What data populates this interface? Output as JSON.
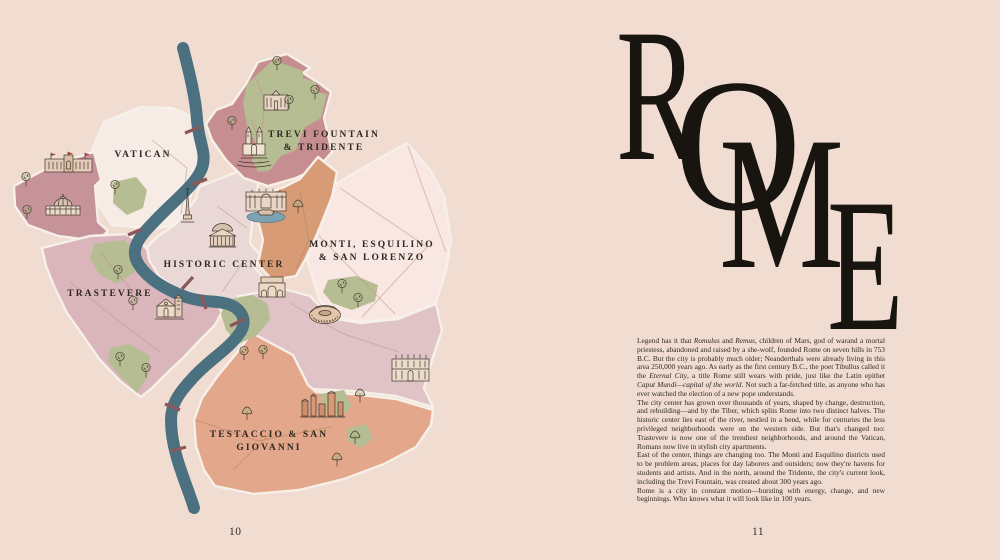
{
  "book": {
    "left_page": {
      "page_number": "10",
      "map_labels": {
        "vatican": "VATICAN",
        "trevi_line1": "TREVI FOUNTAIN",
        "trevi_line2": "& TRIDENTE",
        "historic": "HISTORIC CENTER",
        "monti_line1": "MONTI, ESQUILINO",
        "monti_line2": "& SAN LORENZO",
        "trastevere": "TRASTEVERE",
        "testaccio_line1": "TESTACCIO & SAN",
        "testaccio_line2": "GIOVANNI"
      },
      "landmark_icons": [
        "vatican-museums-icon",
        "st-peters-basilica-icon",
        "obelisk-icon",
        "pantheon-icon",
        "trinita-dei-monti-icon",
        "galleria-borghese-icon",
        "trevi-fountain-icon",
        "colosseum-icon",
        "arch-of-constantine-icon",
        "trastevere-church-icon",
        "san-giovanni-basilica-icon",
        "ancient-ruins-icon",
        "tree-icon",
        "pine-tree-icon",
        "tiber-river",
        "bridge-marks"
      ]
    },
    "right_page": {
      "page_number": "11",
      "title_letters": [
        "R",
        "O",
        "M",
        "E"
      ],
      "paragraphs": [
        [
          {
            "text": "Legend has it that "
          },
          {
            "text": "Romulus",
            "italic": true
          },
          {
            "text": " and "
          },
          {
            "text": "Remus",
            "italic": true
          },
          {
            "text": ", children of Mars, god of warand a mortal priestess, abandoned and raised by a she-wolf, founded Rome on seven hills in 753 B.C. But the city is probably much older; Neanderthals were already living in this area 250,000 years ago. As early as the first century B.C., the poet Tibullus called it the "
          },
          {
            "text": "Eternal City",
            "italic": true
          },
          {
            "text": ", a title Rome still wears with pride, just like the Latin epithet "
          },
          {
            "text": "Caput Mundi—capital of the world",
            "italic": true
          },
          {
            "text": ". Not such a far-fetched title, as anyone who has ever watched the election of a new pope understands."
          }
        ],
        [
          {
            "text": "The city center has grown over thousands of years, shaped by change, destruction, and rebuilding—and by the Tiber, which splits Rome into two distinct halves. The historic center lies east of the river, nestled in a bend, while for centuries the less privileged neighborhoods were on the western side. But that's changed too: Trastevere is now one of the trendiest neighborhoods, and around the Vatican, Romans now live in stylish city apartments."
          }
        ],
        [
          {
            "text": "East of the center, things are changing too. The Monti and Esquilino districts used to be problem areas, places for day laborers and outsiders; now they're havens for students and artists. And in the north, around the Tridente, the city's current look, including the Trevi Fountain, was created about 300 years ago."
          }
        ],
        [
          {
            "text": "Rome is a city in constant motion—bursting with energy, change, and new beginnings. Who knows what it will look like in 100 years."
          }
        ]
      ]
    },
    "colors": {
      "page_background": "#f0dcd1",
      "river": "#4b7181",
      "bridge": "#8a575a",
      "region_vatican": "#f7ece5",
      "region_vatican_west": "#c6939a",
      "region_trevi_tridente": "#c78e92",
      "region_park_green": "#b7bd93",
      "region_tridente_south": "#d79c76",
      "region_historic_center": "#e9d8d5",
      "region_monti": "#f8e7e2",
      "region_san_giovanni": "#dfc3c7",
      "region_trastevere": "#dab6bc",
      "region_testaccio": "#e3a78b",
      "title_ink": "#181410",
      "text_ink": "#2f2a24",
      "label_ink": "#2d2822"
    }
  }
}
